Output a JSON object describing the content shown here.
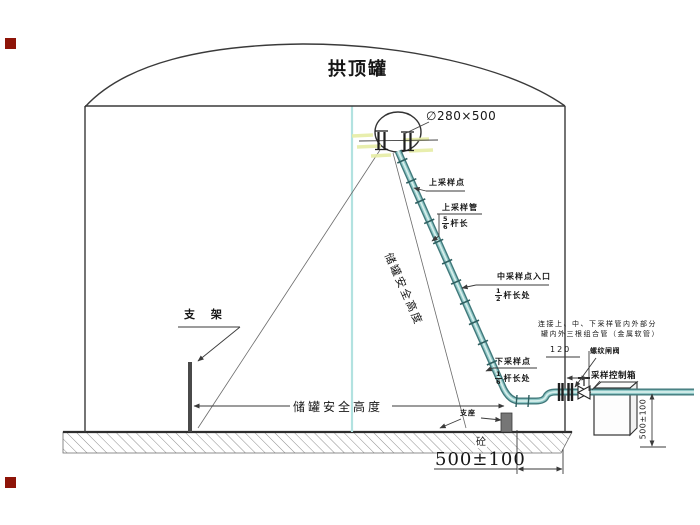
{
  "title": "拱顶罐",
  "manhole": {
    "size_label": "∅280×500"
  },
  "sampling": {
    "upper_point": "上采样点",
    "upper_pipe": "上采样管",
    "upper_fraction": {
      "num": "5",
      "den": "6",
      "suffix": "杆长"
    },
    "middle_point": "中采样点入口",
    "middle_fraction": {
      "num": "1",
      "den": "2",
      "suffix": "杆长处"
    },
    "lower_point": "下采样点",
    "lower_fraction": {
      "num": "1",
      "den": "6",
      "suffix": "杆长处"
    }
  },
  "tank": {
    "safety_height_diagonal": "储罐安全高度",
    "safety_height_bottom": "储罐安全高度"
  },
  "supports": {
    "bracket": "支 架",
    "pedestal": "支座",
    "concrete": "砼"
  },
  "outlet": {
    "valve_label": "螺纹闸阀",
    "control_box_label": "采样控制箱",
    "wall_offset_dim": "120",
    "box_height_dim": "500±100"
  },
  "foundation": {
    "edge_dim": "500±100"
  },
  "note": {
    "line1": "连接上、中、下采样管内外部分",
    "line2": "罐内外三根组合管（金属软管）"
  },
  "colors": {
    "line": "#3a3a3a",
    "pipe_teal": "#41797b",
    "pipe_light": "#d8efec",
    "centerline_cyan": "#b2e2e0",
    "highlight_yellow": "#e6eda5",
    "marker_red": "#8e1408"
  }
}
